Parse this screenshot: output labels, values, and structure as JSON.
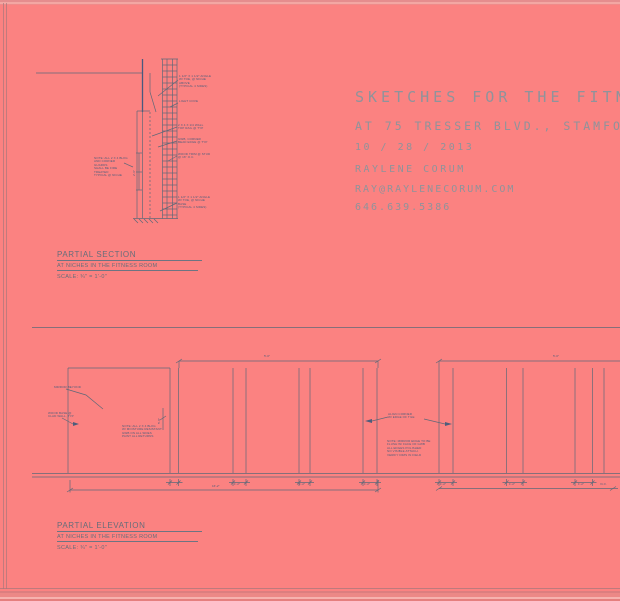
{
  "sheet": {
    "background": "#fb8281",
    "line_color": "#5f6878",
    "accent_line_color": "#49597f",
    "annotation_color": "#4e5d7c",
    "header_color": "#8f939b",
    "title_color": "#666d7a"
  },
  "header": {
    "line1": "SKETCHES FOR THE FITNE",
    "line2": "AT 75 TRESSER BLVD., STAMFORD,",
    "date": "10 / 28 / 2013",
    "name": "RAYLENE CORUM",
    "email": "RAY@RAYLENECORUM.COM",
    "phone": "646.639.5386"
  },
  "section": {
    "title": "PARTIAL SECTION",
    "subtitle": "AT NICHES IN THE FITNESS ROOM",
    "scale": "SCALE: ¾\" = 1'-0\"",
    "callout1": "1 1/2\" X 1 1/2\" ANGLE\nW/ TOE, @ NICHE\nABOVE\n(TYPICAL 4 SIDES)",
    "callout1b": "LIGHT COVE",
    "callout2": "2 X 4 X 1/4 WALL\nTOP RAIL @ TYP",
    "callout3": "GWB, CORNER\nBEAD EDGE @ TYP",
    "callout4": "WOOD TRIM @ STUD\n@ 16\" O.C.",
    "callout5": "1 1/2\" X 1 1/2\" ANGLE\nW/ TOE, @ NICHE\nBASE\n(TYPICAL 4 SIDES)",
    "note_left": "NOTE: ALL 2 X 4 BLKG\nAND CORNER GUARDS\nSHALL BE FIRE TREATED\nTYPICAL @ NICHE",
    "dim_height": "2'-6\""
  },
  "elevation": {
    "title": "PARTIAL ELEVATION",
    "subtitle": "AT NICHES IN THE FITNESS ROOM",
    "scale": "SCALE: ¾\" = 1'-0\"",
    "note_mirror": "MIRROR BEYOND",
    "note_base": "WOOD BASE @\nCLAD WALL, TYP",
    "note_center": "NOTE: ALL 2 X 4 BLKG\nW/ MOISTURE RESISTANT\nGWB ON ALL SIDES\nPAINT ALL RETURNS",
    "note_opening": "ALIGN CORNER\nW/ EDGE OF TILE",
    "note_opening2": "NOTE: MIRROR EDGE TO BE\nFLUSH W/ FACE OF GWB\nALL EDGES POLISHED\nNO VISIBLE ATTACH.\nVERIFY DIMS IN FIELD",
    "dim_top_left": "5'-0\"",
    "dim_top_right": "5'-0\"",
    "dim_bottom_left": "16'-2\"",
    "dim_bottom_right": "V.I.F.",
    "dim_niche_height": "5'-8\"",
    "mullion_dims": [
      "1'-2\"",
      "1'-2\"",
      "1'-2\"",
      "1'-2\"",
      "1'-2\"",
      "1'-2\""
    ]
  }
}
